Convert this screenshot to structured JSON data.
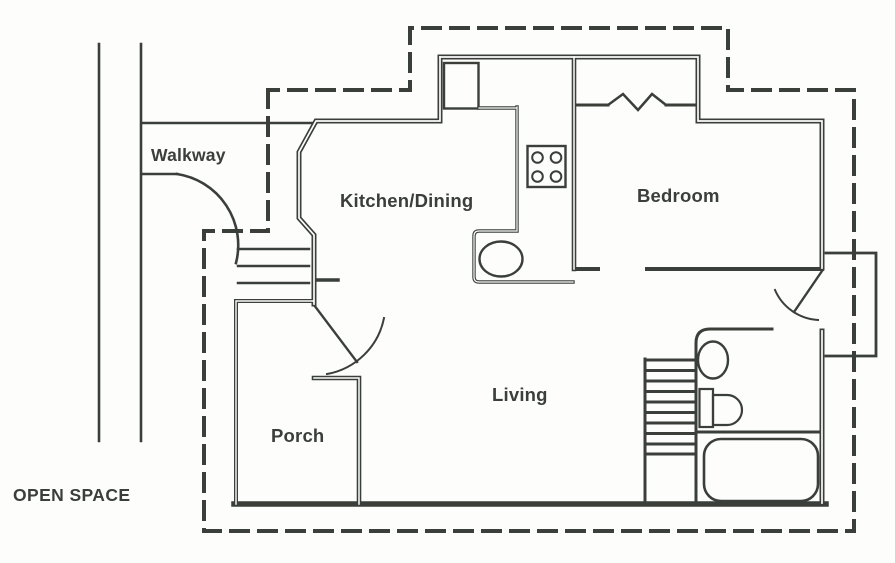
{
  "title": "Apartment floor plan with walkway and open space",
  "colors": {
    "ink": "#3a3f3a",
    "background": "#fdfdfc"
  },
  "labels": {
    "walkway": "Walkway",
    "kitchen_dining": "Kitchen/Dining",
    "bedroom": "Bedroom",
    "living": "Living",
    "porch": "Porch",
    "open_space": "OPEN SPACE"
  },
  "fixtures": {
    "kitchen": [
      "pantry",
      "stove-4-burner",
      "kitchen-sink",
      "counter"
    ],
    "bathroom": [
      "sink",
      "toilet",
      "bathtub"
    ],
    "bedroom": [
      "closet-accordion-door"
    ],
    "circulation": [
      "entry-steps",
      "interior-stairs",
      "entry-door",
      "rear-door",
      "porch-posts"
    ],
    "site": [
      "property-boundary-dashed",
      "walkway-path",
      "exterior-landing"
    ]
  }
}
